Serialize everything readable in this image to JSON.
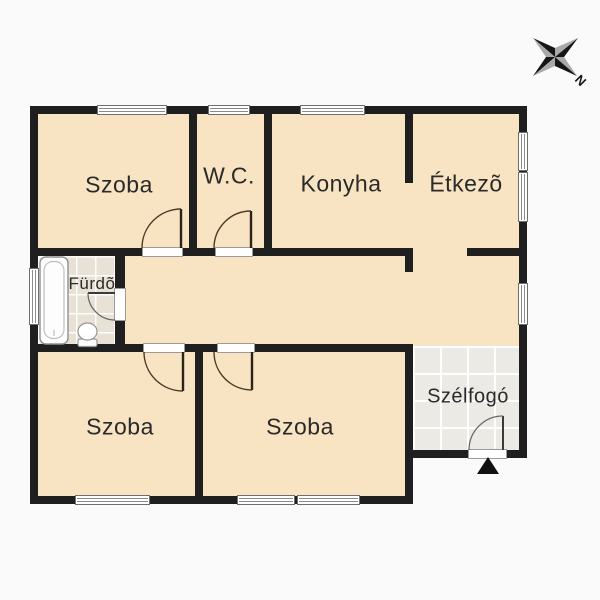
{
  "compass": {
    "north_label": "N"
  },
  "rooms": [
    {
      "id": "szoba-top-left",
      "label": "Szoba"
    },
    {
      "id": "wc",
      "label": "W.C."
    },
    {
      "id": "konyha",
      "label": "Konyha"
    },
    {
      "id": "etkezo",
      "label": "Étkezõ"
    },
    {
      "id": "furdo",
      "label": "Fürdõ"
    },
    {
      "id": "szoba-bottom-left",
      "label": "Szoba"
    },
    {
      "id": "szoba-bottom-middle",
      "label": "Szoba"
    },
    {
      "id": "szelfogo",
      "label": "Szélfogó"
    }
  ],
  "colors": {
    "wall": "#1f1f1f",
    "room_fill": "#f8e4c3",
    "bathroom_tile": "#e8e2d6",
    "entry_tile": "#eceae5",
    "label_text": "#2a2a2a",
    "background": "#fafafa"
  },
  "fixtures": [
    "bathtub",
    "toilet",
    "entrance-arrow",
    "compass-rose"
  ]
}
